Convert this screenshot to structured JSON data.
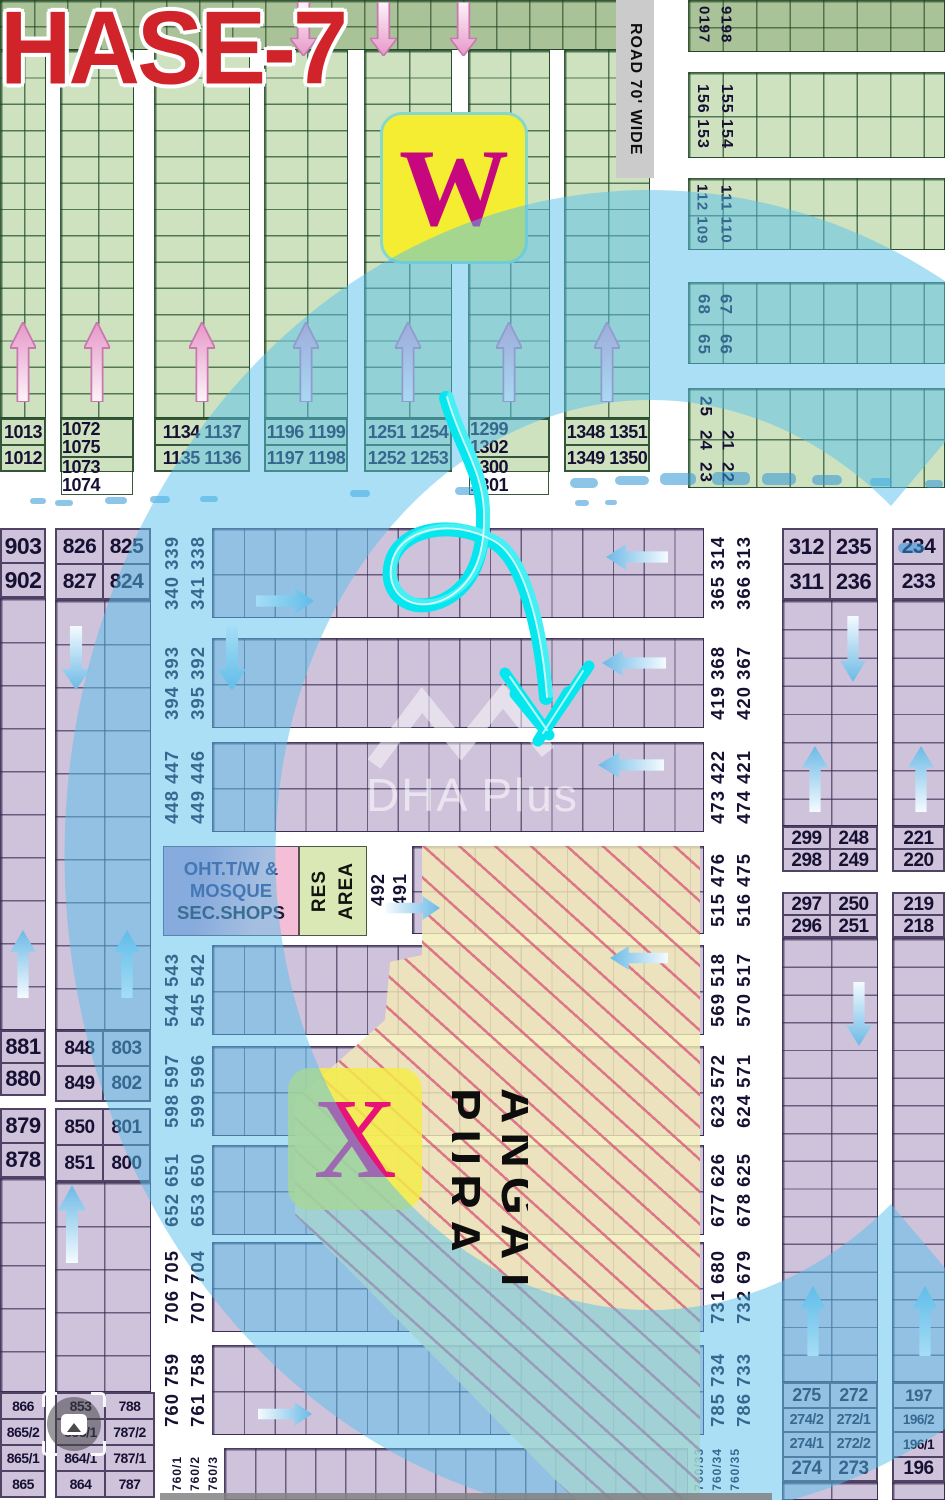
{
  "image_type": "housing scheme plot map",
  "colors": {
    "title_red": "#d2242a",
    "badge_yellow": "#f2ea35",
    "badge_magenta": "#c6077e",
    "overlay_blue": "#56c0eb",
    "marker_cyan": "#00e8f0",
    "plot_green": "#cfe2c0",
    "plot_green_dark": "#a9c297",
    "plot_purple": "#cfc3db",
    "hatch_red": "#d65276"
  },
  "green": {
    "title": "HASE-7",
    "road_label": "ROAD 70' WIDE",
    "w_marker": "W",
    "columns": [
      [
        "1013",
        "1012"
      ],
      [
        "1072 1075",
        "1073 1074"
      ],
      [
        "1134 1137",
        "1135 1136"
      ],
      [
        "1196 1199",
        "1197 1198"
      ],
      [
        "1251 1254",
        "1252 1253"
      ],
      [
        "1299 1302",
        "1300 1301"
      ],
      [
        "1348 1351",
        "1349 1350"
      ]
    ],
    "right_strips": [
      [
        "0197",
        "9198"
      ],
      [
        "156 153",
        "155 154"
      ],
      [
        "112 109",
        "111 110"
      ],
      [
        "68",
        "67",
        "65",
        "66"
      ],
      [
        "25",
        "24",
        "23",
        "21",
        "22"
      ]
    ]
  },
  "purple": {
    "strips": [
      {
        "left": [
          "340 339",
          "341 338"
        ],
        "right": [
          "365 314",
          "366 313"
        ]
      },
      {
        "left": [
          "394 393",
          "395 392"
        ],
        "right": [
          "419 368",
          "420 367"
        ]
      },
      {
        "left": [
          "448 447",
          "449 446"
        ],
        "right": [
          "473 422",
          "474 421"
        ]
      },
      {
        "left": [],
        "right": [
          "515 476",
          "516 475"
        ]
      },
      {
        "left": [
          "544 543",
          "545 542"
        ],
        "right": [
          "569 518",
          "570 517"
        ]
      },
      {
        "left": [
          "598 597",
          "599 596"
        ],
        "right": [
          "623 572",
          "624 571"
        ]
      },
      {
        "left": [
          "652 651",
          "653 650"
        ],
        "right": [
          "677 626",
          "678 625"
        ]
      },
      {
        "left": [
          "706 705",
          "707 704"
        ],
        "right": [
          "731 680",
          "732 679"
        ]
      },
      {
        "left": [
          "760 759",
          "761 758"
        ],
        "right": [
          "785 734",
          "786 733"
        ]
      },
      {
        "left": [
          "760/1",
          "760/2",
          "760/3"
        ],
        "right": [
          "760/33",
          "760/34",
          "760/35"
        ]
      }
    ],
    "col_a": {
      "header": [
        "903",
        "902"
      ],
      "mid1": [
        "881",
        "880"
      ],
      "mid2": [
        "879",
        "878"
      ],
      "bottom": [
        "866",
        "865/2",
        "865/1",
        "865"
      ]
    },
    "col_b": {
      "header": [
        "826",
        "825",
        "827",
        "824"
      ],
      "mid1": [
        "848",
        "803",
        "849",
        "802"
      ],
      "mid2": [
        "850",
        "801",
        "851",
        "800"
      ],
      "bottom": [
        "853",
        "788",
        "853/1",
        "787/2",
        "864/1",
        "787/1",
        "864",
        "787"
      ]
    },
    "col_c": {
      "header": [
        "312",
        "235",
        "311",
        "236"
      ],
      "mid1": [
        "299",
        "248",
        "298",
        "249"
      ],
      "mid2": [
        "297",
        "250",
        "296",
        "251"
      ],
      "bottom": [
        "275",
        "272",
        "274/2",
        "272/1",
        "274/1",
        "272/2",
        "274",
        "273"
      ]
    },
    "col_d": {
      "header": [
        "234",
        "233"
      ],
      "mid1": [
        "221",
        "220"
      ],
      "mid2": [
        "219",
        "218"
      ],
      "bottom": [
        "197",
        "196/2",
        "196/1",
        "196"
      ]
    },
    "oht_lines": [
      "OHT.T/W &",
      "MOSQUE",
      "SEC.SHOPS"
    ],
    "res_area_lines": [
      "RES",
      "AREA"
    ],
    "res_pair": [
      "492",
      "491"
    ],
    "x_marker": "X",
    "area_name": "ANGAT PURA"
  },
  "watermark": {
    "text": "DHA Plus",
    "logo": "chevron-logo"
  },
  "ui": {
    "camera_button_icon": "camera-lens-icon"
  }
}
